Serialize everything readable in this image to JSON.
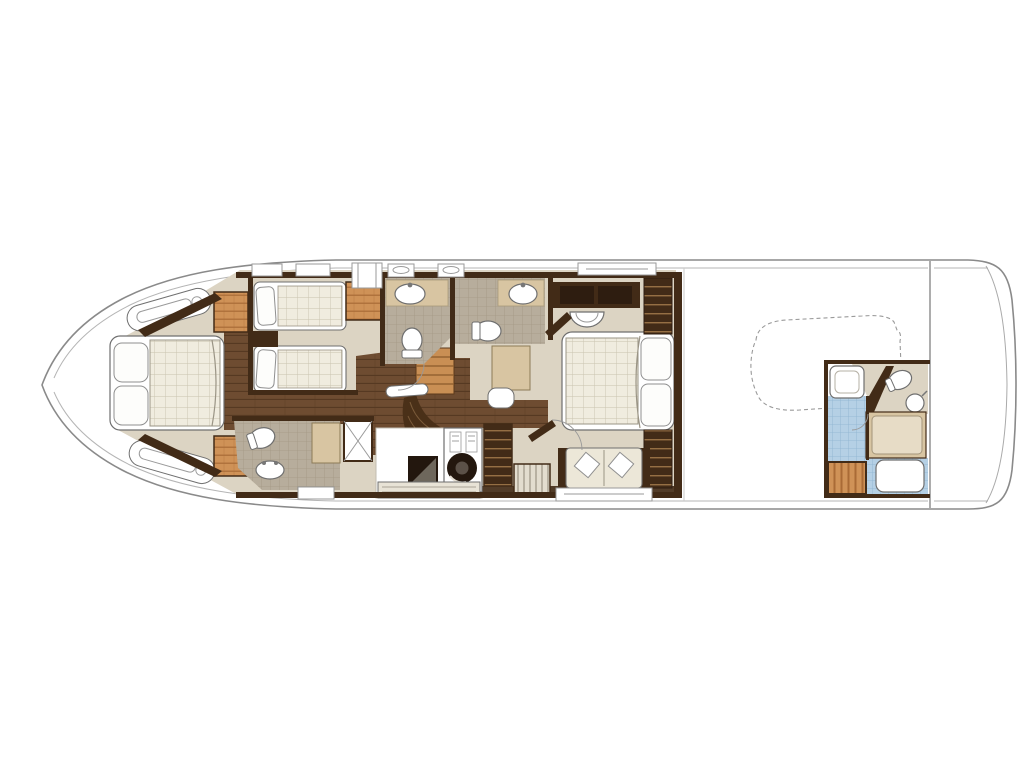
{
  "diagram": {
    "type": "yacht-deck-floor-plan",
    "label": "Yacht lower-deck floor plan",
    "areas": [
      "vip-cabin-bow",
      "twin-guest-cabin",
      "guest-bathroom-forward",
      "day-head-bathroom",
      "companionway-stairs",
      "guest-bathroom-aft",
      "laundry-utility",
      "master-cabin",
      "engine-room",
      "tender-stowage-outline",
      "crew-cabin",
      "swim-platform"
    ]
  },
  "palette": {
    "page_bg": "#ffffff",
    "hull_line": "#8a8a8a",
    "deck_line": "#b5b5b5",
    "faint_line": "#c2bdb2",
    "wall_wood": "#422b17",
    "wood_dark": "#2e1d10",
    "floor_beige": "#dcd4c3",
    "floor_wood": "#6e4c31",
    "plank_line": "#53361f",
    "stair_wood": "#4a3018",
    "stair_tread": "#c98f54",
    "stair_tread_line": "#8a5a2b",
    "wardrobe_tan": "#cf9257",
    "wardrobe_stripe": "#a96b36",
    "counter_tan": "#d8c5a2",
    "tile_grey": "#b7ad9c",
    "tile_line": "#a39884",
    "tile_blue": "#b5d0e5",
    "tile_blue_line": "#8db3d0",
    "linen": "#f0ecdf",
    "linen_line": "#c9c2ae",
    "fixture_white": "#fdfdfb",
    "fixture_stroke": "#6f6f6f",
    "sofa_cream": "#ece7d8",
    "machine_dark": "#23170e",
    "dashed_line": "#9a9a9a",
    "bench_wood": "#e8e3d6",
    "mattress_tan": "#e7dcc6",
    "hang_bg": "#e3ddcf",
    "hang_line": "#8d8576"
  }
}
